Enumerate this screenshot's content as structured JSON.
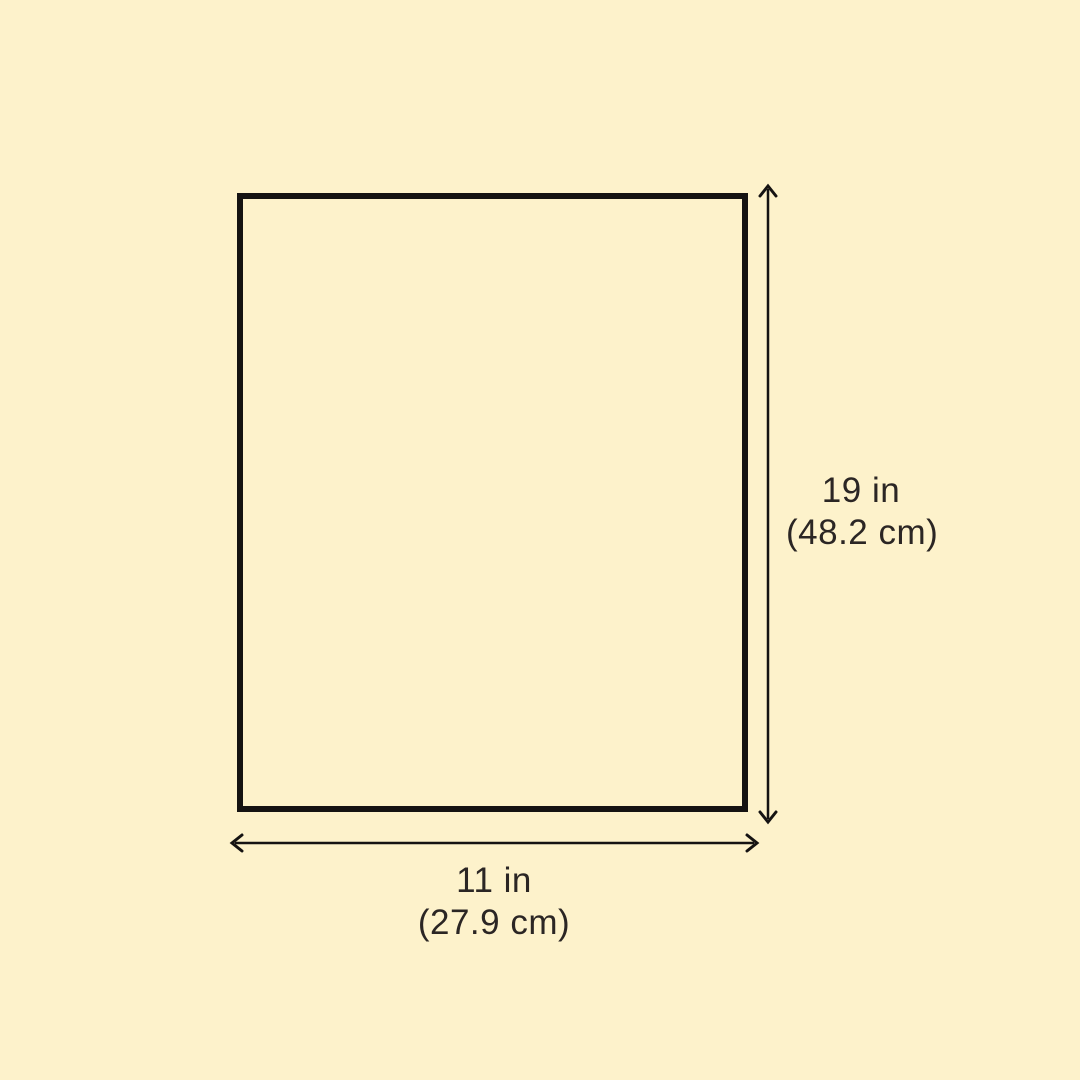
{
  "page": {
    "background_color": "#FDF2CB"
  },
  "diagram": {
    "shape": "rectangle-outline",
    "line_color": "#151312",
    "text_color": "#2B2624",
    "height_dimension": {
      "label_in": "19 in",
      "label_cm": "(48.2 cm)"
    },
    "width_dimension": {
      "label_in": "11 in",
      "label_cm": "(27.9 cm)"
    }
  }
}
